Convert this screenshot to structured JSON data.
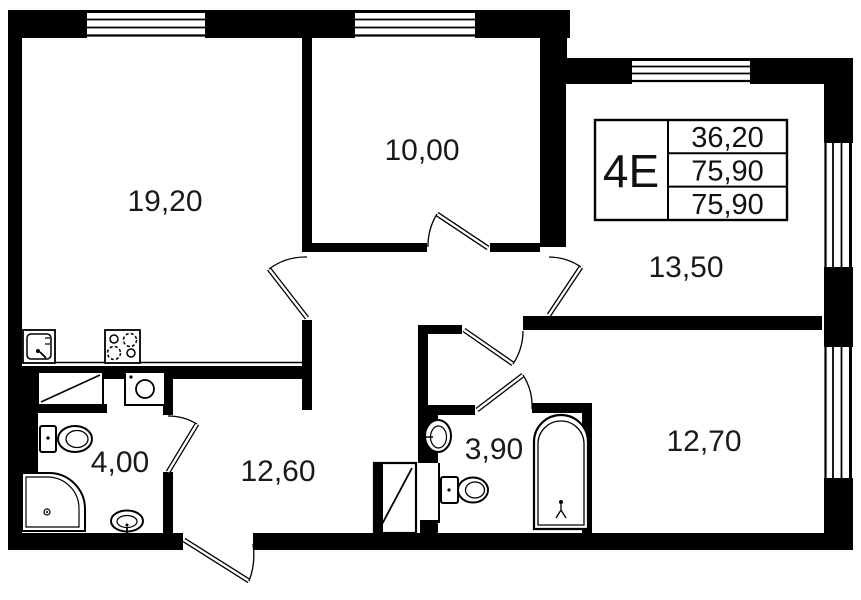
{
  "unit": {
    "type_label": "4E",
    "area_values": [
      "36,20",
      "75,90",
      "75,90"
    ]
  },
  "rooms": [
    {
      "id": "living-kitchen",
      "area_label": "19,20"
    },
    {
      "id": "bedroom",
      "area_label": "10,00"
    },
    {
      "id": "room-upper-right",
      "area_label": "13,50"
    },
    {
      "id": "hallway",
      "area_label": "12,60"
    },
    {
      "id": "bathroom-shower",
      "area_label": "4,00"
    },
    {
      "id": "bathroom-tub",
      "area_label": "3,90"
    },
    {
      "id": "room-lower-right",
      "area_label": "12,70"
    }
  ],
  "colors": {
    "walls": "#000000",
    "background": "#ffffff",
    "text": "#1a1a1a"
  },
  "fixtures": [
    "kitchen-sink",
    "stove",
    "ventilation-shaft",
    "washing-machine",
    "toilet",
    "corner-shower",
    "wash-basin",
    "toilet",
    "bathtub",
    "wash-basin",
    "wardrobe"
  ]
}
